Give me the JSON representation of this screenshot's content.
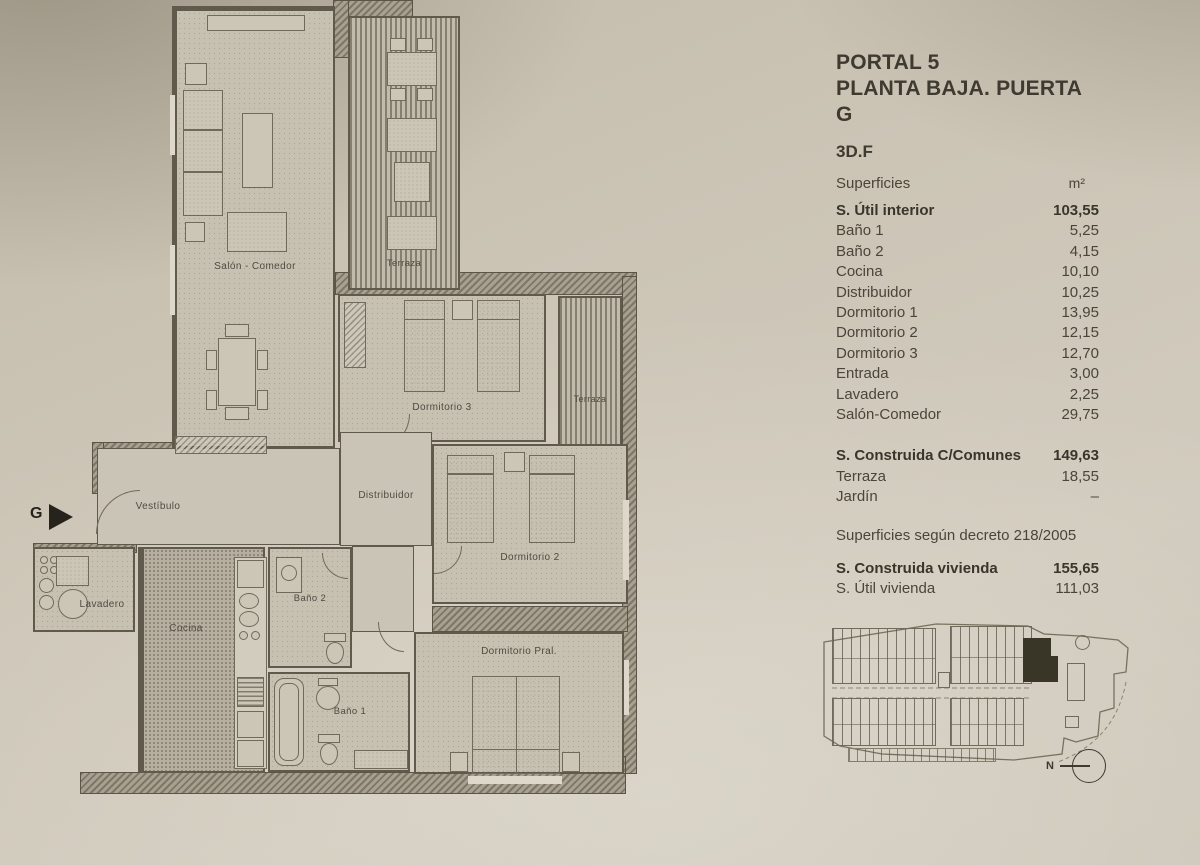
{
  "header": {
    "portal": "PORTAL 5",
    "floor": "PLANTA BAJA. PUERTA G",
    "unit_type": "3D.F",
    "surfaces_label": "Superficies",
    "unit_label": "m²"
  },
  "surface_tables": {
    "interior": {
      "total_label": "S. Útil interior",
      "total_value": "103,55",
      "rows": [
        {
          "label": "Baño 1",
          "value": "5,25"
        },
        {
          "label": "Baño 2",
          "value": "4,15"
        },
        {
          "label": "Cocina",
          "value": "10,10"
        },
        {
          "label": "Distribuidor",
          "value": "10,25"
        },
        {
          "label": "Dormitorio 1",
          "value": "13,95"
        },
        {
          "label": "Dormitorio 2",
          "value": "12,15"
        },
        {
          "label": "Dormitorio 3",
          "value": "12,70"
        },
        {
          "label": "Entrada",
          "value": "3,00"
        },
        {
          "label": "Lavadero",
          "value": "2,25"
        },
        {
          "label": "Salón-Comedor",
          "value": "29,75"
        }
      ]
    },
    "construida": {
      "total_label": "S. Construida C/Comunes",
      "total_value": "149,63",
      "rows": [
        {
          "label": "Terraza",
          "value": "18,55"
        },
        {
          "label": "Jardín",
          "value": "–"
        }
      ]
    },
    "decree_note": "Superficies según decreto 218/2005",
    "vivienda": {
      "rows": [
        {
          "label": "S. Construida vivienda",
          "value": "155,65"
        },
        {
          "label": "S. Útil vivienda",
          "value": "111,03"
        }
      ]
    }
  },
  "floorplan": {
    "entrance_label": "G",
    "rooms": {
      "salon": "Salón - Comedor",
      "terraza_top": "Terraza",
      "terraza_right": "Terraza",
      "dormitorio3": "Dormitorio 3",
      "distribuidor": "Distribuidor",
      "vestibulo": "Vestíbulo",
      "lavadero": "Lavadero",
      "cocina": "Cocina",
      "bano2": "Baño 2",
      "dormitorio2": "Dormitorio 2",
      "bano1": "Baño 1",
      "dormitorio_pral": "Dormitorio Pral."
    }
  },
  "siteplan": {
    "north_label": "N"
  },
  "colors": {
    "paper": "#ccc5b6",
    "ink": "#5f5a4c",
    "text": "#4a4539",
    "highlight_unit": "#393628"
  }
}
